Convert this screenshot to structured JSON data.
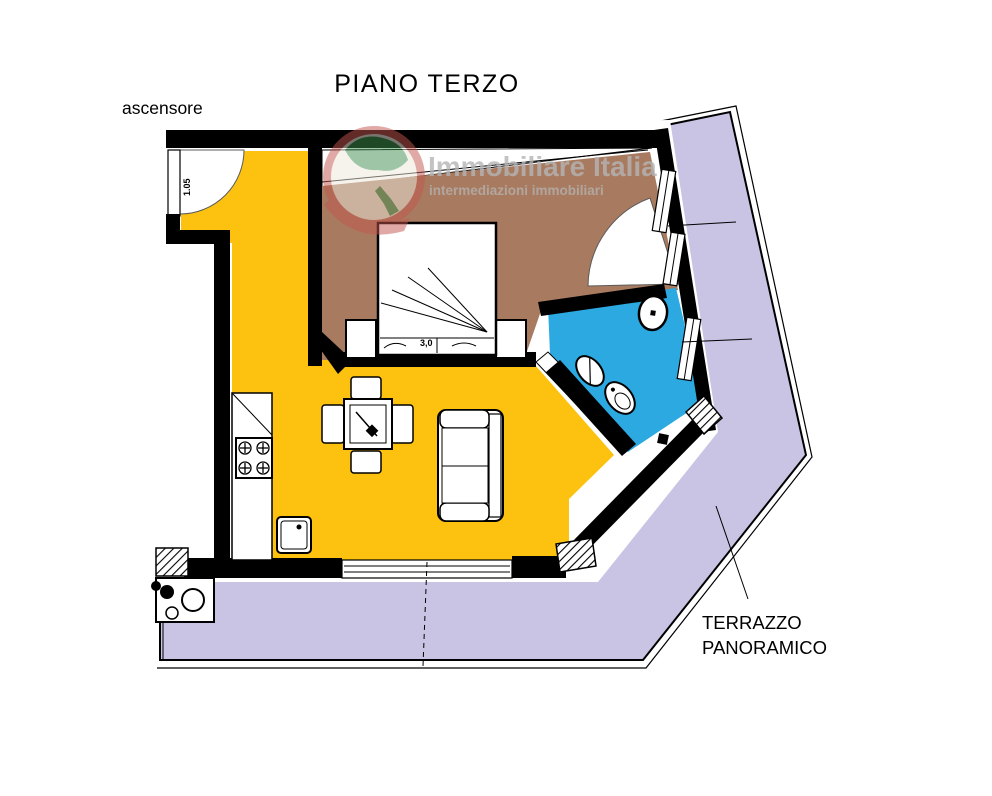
{
  "page": {
    "title": "PIANO TERZO"
  },
  "labels": {
    "elevator": "ascensore",
    "terrace_line1": "TERRAZZO",
    "terrace_line2": "PANORAMICO",
    "entrance_door_width": "1.05",
    "bed_width": "3,0"
  },
  "watermark": {
    "name": "Immobiliare Italia",
    "tagline": "intermediazioni immobiliari"
  },
  "colors": {
    "living_kitchen": "#FDC20F",
    "bedroom": "#A87B60",
    "bathroom": "#2BA9E0",
    "terrace": "#C9C3E4",
    "wall": "#000000",
    "watermark_text": "#B5B5B5",
    "logo_red": "#C4564E",
    "logo_green": "#3F8F4F"
  }
}
